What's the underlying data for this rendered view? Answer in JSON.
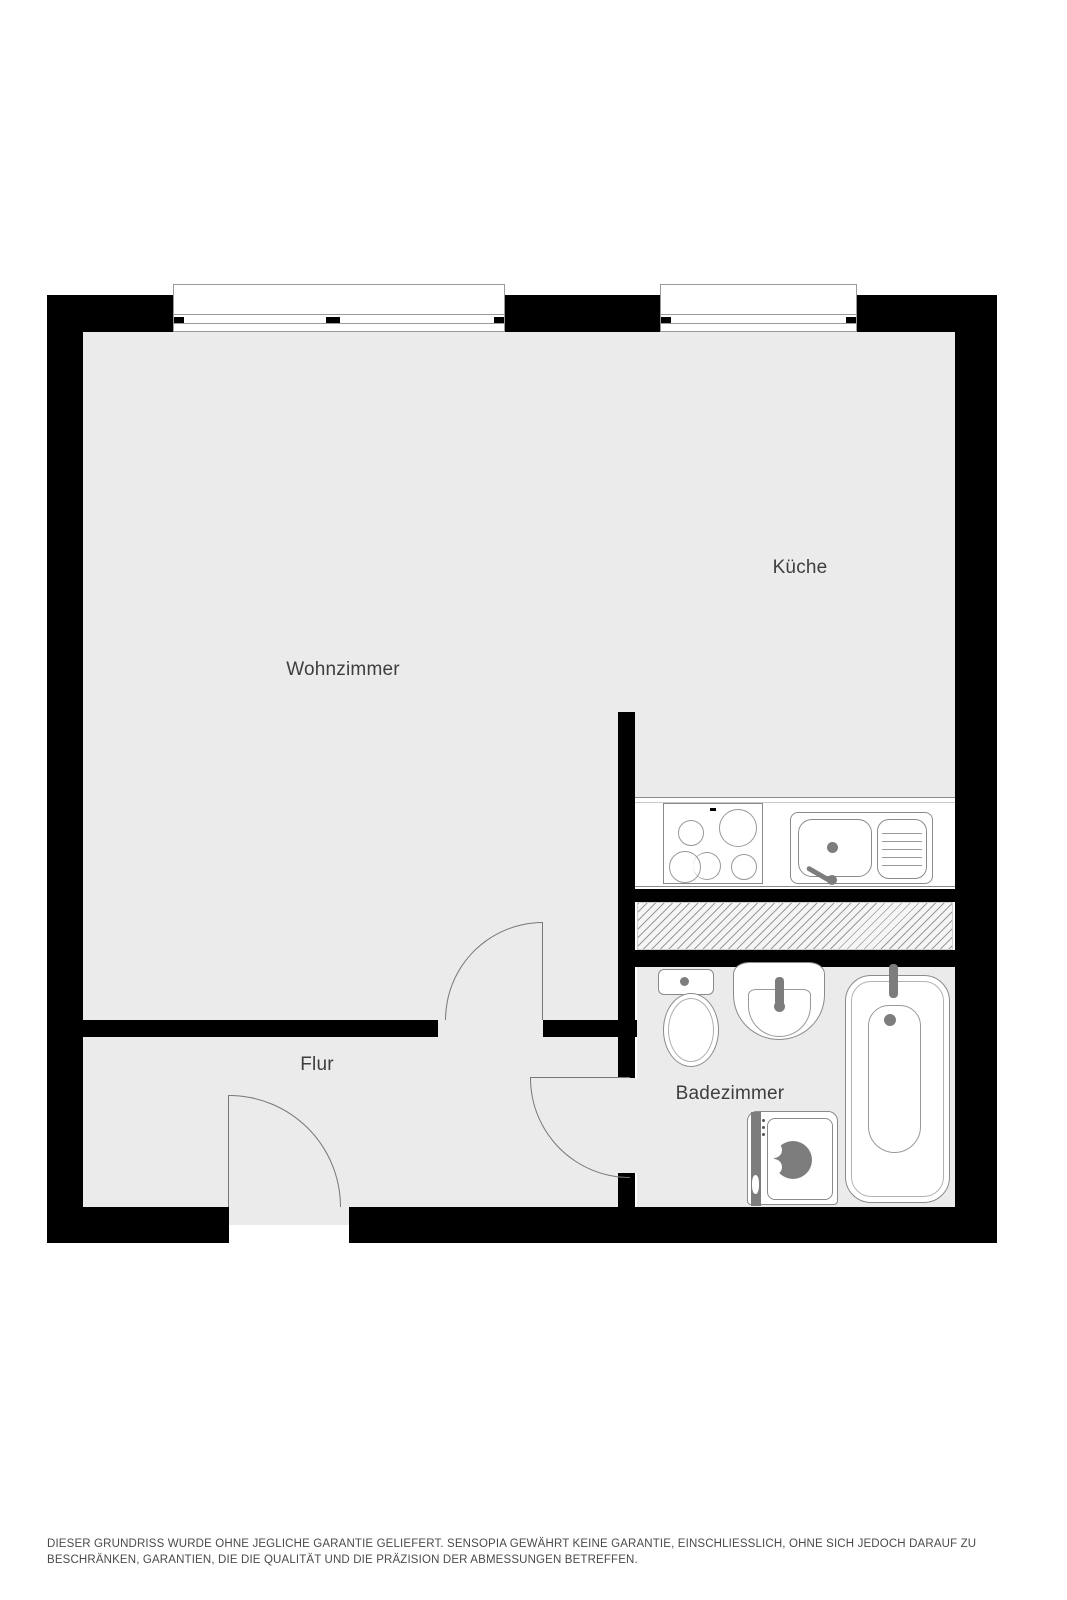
{
  "plan": {
    "rooms": {
      "living": "Wohnzimmer",
      "kitchen": "Küche",
      "hall": "Flur",
      "bath": "Badezimmer"
    }
  },
  "disclaimer": {
    "text": "DIESER GRUNDRISS WURDE OHNE JEGLICHE GARANTIE GELIEFERT. SENSOPIA GEWÄHRT KEINE GARANTIE, EINSCHLIESSLICH, OHNE SICH JEDOCH DARAUF ZU BESCHRÄNKEN, GARANTIEN, DIE DIE QUALITÄT UND DIE PRÄZISION DER ABMESSUNGEN BETREFFEN."
  },
  "colors": {
    "wall": "#000000",
    "floor": "#ebebeb",
    "outline": "#8a8a8a",
    "accent": "#7d7d7d",
    "hatch": "#9a9a9a",
    "label": "#3e3e3e",
    "note": "#4a4a4a"
  }
}
